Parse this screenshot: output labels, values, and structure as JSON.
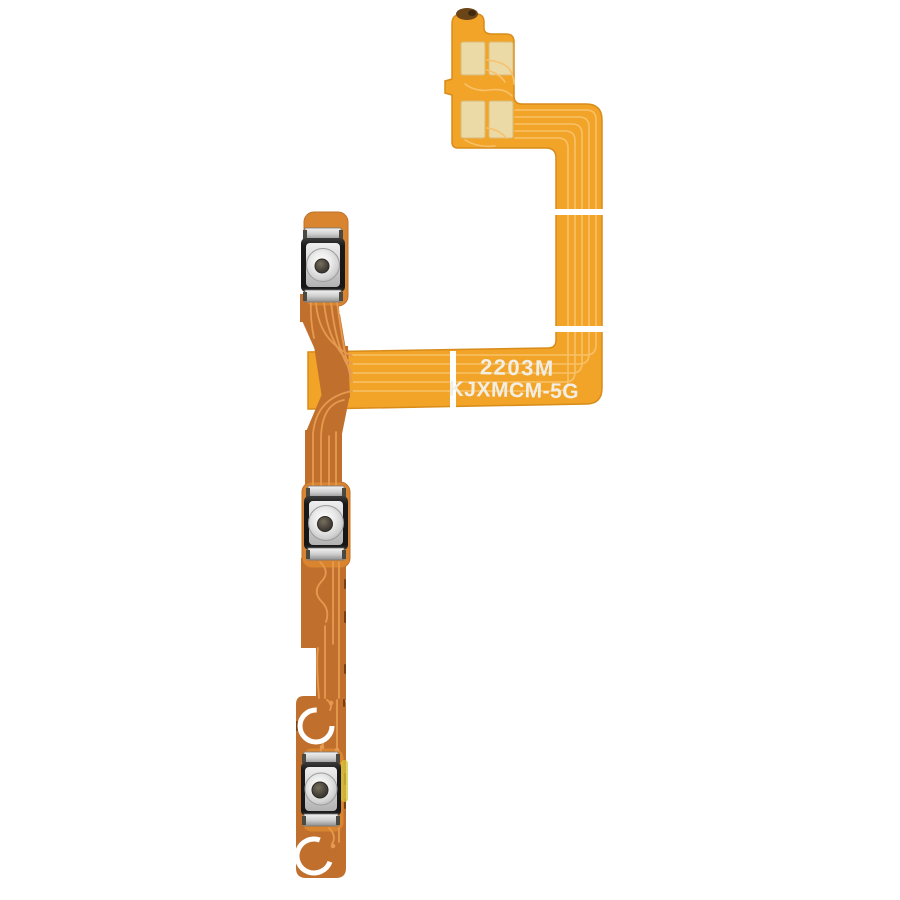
{
  "image": {
    "description": "Product photo of a power and volume button flex cable (FPC) spare part on a white background",
    "background": "#ffffff"
  },
  "part": {
    "markings": {
      "line1": "2203M",
      "line2": "KJXMCM-5G"
    },
    "features": {
      "connector_pads": 4,
      "tactile_switches": 3,
      "alignment_rings": 2,
      "stiffener_dividers": 2
    }
  },
  "colors": {
    "background": "#ffffff",
    "flex_bright": "#F2A428",
    "flex_bright_edge": "#D88C1A",
    "flex_dark": "#C0702C",
    "button_backing": "#D9842E",
    "pad_cream": "#EBD9A6",
    "trace_light_bright": "#F8C169",
    "trace_light_dark": "#E59A4F",
    "trace_deep": "#7A3F10",
    "divider_white": "#FFFFFF",
    "ring_white": "#FFFFFF",
    "text_white": "#F2EEE3",
    "smudge_yellow": "#D5C53C",
    "kapton_brown": "#6B4518"
  }
}
